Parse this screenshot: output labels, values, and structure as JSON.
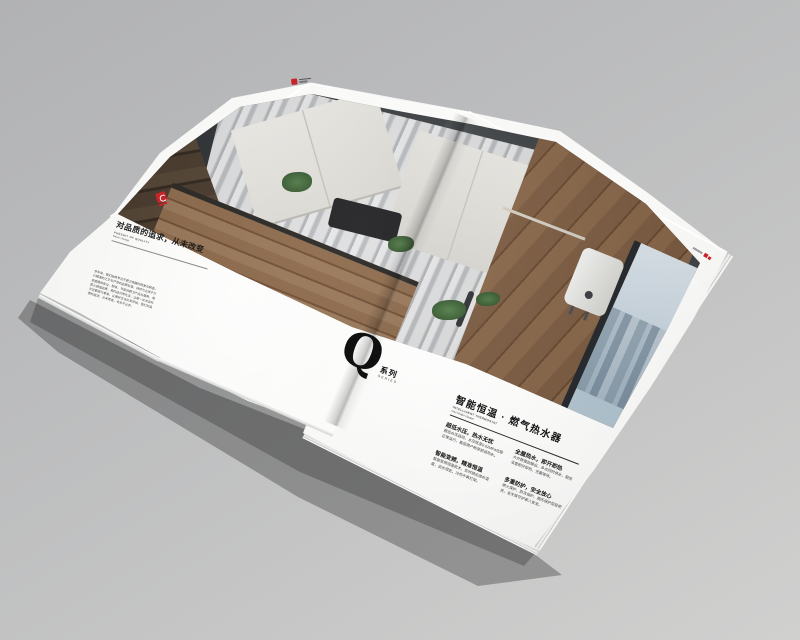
{
  "scene": {
    "description_colors": {
      "brand_red": "#c62428",
      "page_white": "#f6f6f4",
      "background_gray": "#bfbfc1",
      "ceiling_charcoal": "#35393c",
      "wood_brown": "#7d5b40",
      "marble_gray": "#c9cacc",
      "window_blue": "#cfdde8"
    }
  },
  "left_page": {
    "heading": "对品质的追求，从未改变",
    "subtitle_en_1": "PURSUIT OF QUALITY",
    "subtitle_en_2": "Never change",
    "body_lines": [
      "多年来，我们始终专注于厨卫电器的研发与制造，",
      "以精湛的工艺与严苛的品质标准，持续为全球千万",
      "家庭提供安全、舒适、节能的厨卫产品与服务，用",
      "匠心铸造品质，用科技点亮生活，让每一次沐浴与",
      "烹饪都成为享受，让美好生活从家开始。我们对品",
      "质的追求，从未改变，也永不止步。"
    ]
  },
  "right_page": {
    "series_letter": "Q",
    "series_cn": "系列",
    "series_en": "SERIES",
    "heading": "智能恒温 · 燃气热水器",
    "subtitle_en_1": "INTELLIGENT THERMOSTAT",
    "subtitle_en_2": "Gas Water Heater",
    "features": [
      {
        "title": "超低水压，热水无忧",
        "body": "超低水压启动，水压低至0.02MPa也能正常运行，高层用户畅享舒适热水。"
      },
      {
        "title": "全屋热水，即开即热",
        "body": "大升数强劲输出，多点同时供水，厨房浴室即开即热，无需等待。"
      },
      {
        "title": "智能变频，精准恒温",
        "body": "智能变频恒温技术，实时感应进水温度，出水恒定，冷热不再打架。"
      },
      {
        "title": "多重防护，安全放心",
        "body": "熄火保护、防冻保护、超压保护层层把关，全天候守护家人安全。"
      }
    ]
  }
}
